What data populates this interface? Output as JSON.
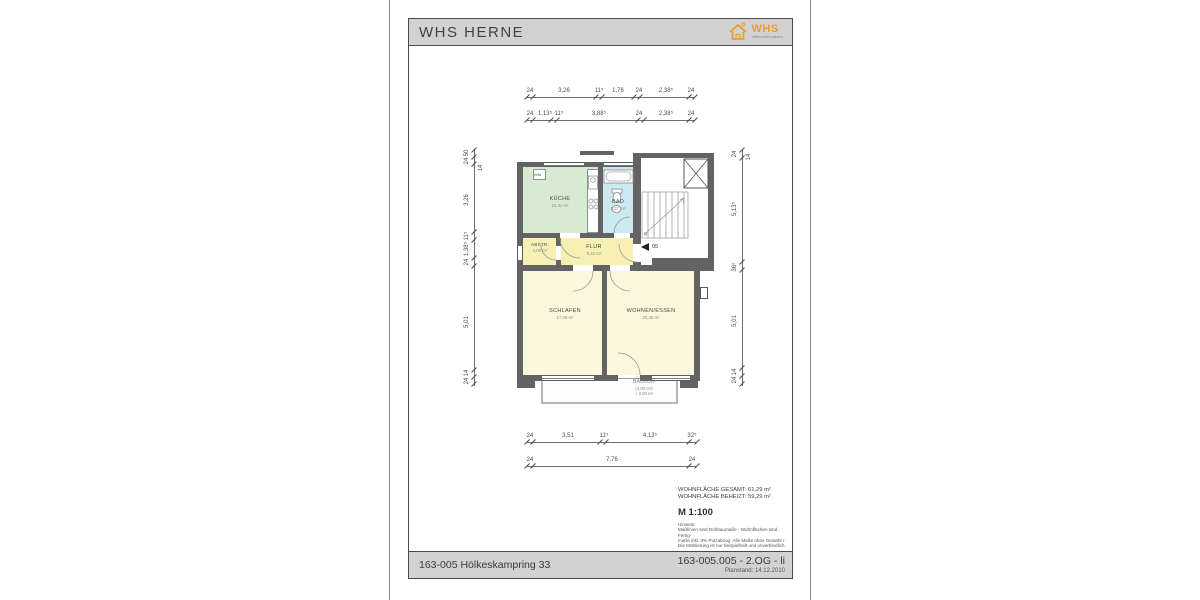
{
  "header": {
    "title": "WHS HERNE",
    "logo_text": "WHS",
    "logo_tagline": "Willkommen daheim."
  },
  "footer": {
    "left": "163-005 Hölkeskampring 33",
    "right_main": "163-005.005 - 2.OG - li",
    "right_sub": "Planstand: 14.12.2010"
  },
  "summary": {
    "rows": [
      {
        "label": "WOHNFLÄCHE GESAMT:",
        "value": "61,29 m²"
      },
      {
        "label": "WOHNFLÄCHE BEHEIZT:",
        "value": "59,29 m²"
      }
    ],
    "scale": "M 1:100",
    "note_title": "Hinweis:",
    "note_lines": [
      "Maßlinien sind Rohbaumaße - Wohnflächen sind Fertig-",
      "maße inkl. 3% Putzabzug. Alle Maße ohne Gewähr !",
      "Die Möblierung ist nur beispielhaft und unverbindlich."
    ]
  },
  "plan": {
    "rooms": {
      "kueche": {
        "name": "KÜCHE",
        "area": "10,31 m²"
      },
      "bad": {
        "name": "BAD",
        "area": "5,57 m²"
      },
      "abstr": {
        "name": "ABSTR.",
        "area": "1,02 m²"
      },
      "flur": {
        "name": "FLUR",
        "area": "5,22 m²"
      },
      "schlafen": {
        "name": "SCHLAFEN",
        "area": "17,06 m²"
      },
      "wohnen": {
        "name": "WOHNEN/ESSEN",
        "area": "20,36 m²"
      },
      "balkon": {
        "name": "BALKON",
        "line1": "(4,00 m²)",
        "line2": "+ 2,00 m²"
      }
    },
    "labels": {
      "wm": "WM",
      "door": "05"
    },
    "colors": {
      "kueche": "#d8ebd2",
      "bad": "#cde9f0",
      "flur": "#f6f0b4",
      "zimmer": "#fbf7dc",
      "wall": "#636363",
      "accent": "#ee9b2e"
    },
    "dims": {
      "h": [
        {
          "y": 97,
          "x1": 527,
          "x2": 695,
          "ticks": [
            527,
            533,
            596,
            602,
            634,
            640,
            689,
            695
          ],
          "labels": [
            {
              "t": "24",
              "x": 530
            },
            {
              "t": "3,26",
              "x": 564
            },
            {
              "t": "11⁵",
              "x": 599
            },
            {
              "t": "1,76",
              "x": 618
            },
            {
              "t": "24",
              "x": 639
            },
            {
              "t": "2,38⁵",
              "x": 666
            },
            {
              "t": "24",
              "x": 691
            }
          ]
        },
        {
          "y": 120,
          "x1": 527,
          "x2": 695,
          "ticks": [
            527,
            533,
            551,
            557,
            638,
            644,
            689,
            695
          ],
          "labels": [
            {
              "t": "24",
              "x": 530
            },
            {
              "t": "1,13⁵",
              "x": 545
            },
            {
              "t": "11⁵",
              "x": 559
            },
            {
              "t": "3,88⁵",
              "x": 599
            },
            {
              "t": "24",
              "x": 639
            },
            {
              "t": "2,38⁵",
              "x": 666
            },
            {
              "t": "24",
              "x": 691
            }
          ]
        },
        {
          "y": 442,
          "x1": 527,
          "x2": 697,
          "ticks": [
            527,
            533,
            600,
            606,
            689,
            697
          ],
          "labels": [
            {
              "t": "24",
              "x": 530
            },
            {
              "t": "3,51",
              "x": 568
            },
            {
              "t": "11⁵",
              "x": 604
            },
            {
              "t": "4,13⁵",
              "x": 650
            },
            {
              "t": "32⁵",
              "x": 692
            }
          ]
        },
        {
          "y": 466,
          "x1": 527,
          "x2": 697,
          "ticks": [
            527,
            533,
            689,
            697
          ],
          "labels": [
            {
              "t": "24",
              "x": 530
            },
            {
              "t": "7,76",
              "x": 612
            },
            {
              "t": "24",
              "x": 692
            }
          ]
        }
      ],
      "v": [
        {
          "x": 474,
          "y1": 150,
          "y2": 386,
          "ticks": [
            150,
            157,
            164,
            232,
            240,
            258,
            266,
            370,
            377,
            384
          ],
          "labels": [
            {
              "t": "50",
              "y": 153
            },
            {
              "t": "24",
              "y": 161
            },
            {
              "t": "14",
              "y": 168,
              "side": "r"
            },
            {
              "t": "3,26",
              "y": 200
            },
            {
              "t": "11⁵",
              "y": 236
            },
            {
              "t": "1,38⁵",
              "y": 249
            },
            {
              "t": "24",
              "y": 262
            },
            {
              "t": "5,01",
              "y": 322
            },
            {
              "t": "14",
              "y": 373
            },
            {
              "t": "24",
              "y": 381
            }
          ]
        },
        {
          "x": 742,
          "y1": 150,
          "y2": 386,
          "ticks": [
            150,
            158,
            262,
            270,
            368,
            376,
            384
          ],
          "labels": [
            {
              "t": "24",
              "y": 154
            },
            {
              "t": "14",
              "y": 157,
              "side": "r"
            },
            {
              "t": "5,13⁵",
              "y": 209
            },
            {
              "t": "36⁵",
              "y": 267
            },
            {
              "t": "5,01",
              "y": 321
            },
            {
              "t": "14",
              "y": 372
            },
            {
              "t": "24",
              "y": 380
            }
          ]
        }
      ]
    }
  }
}
